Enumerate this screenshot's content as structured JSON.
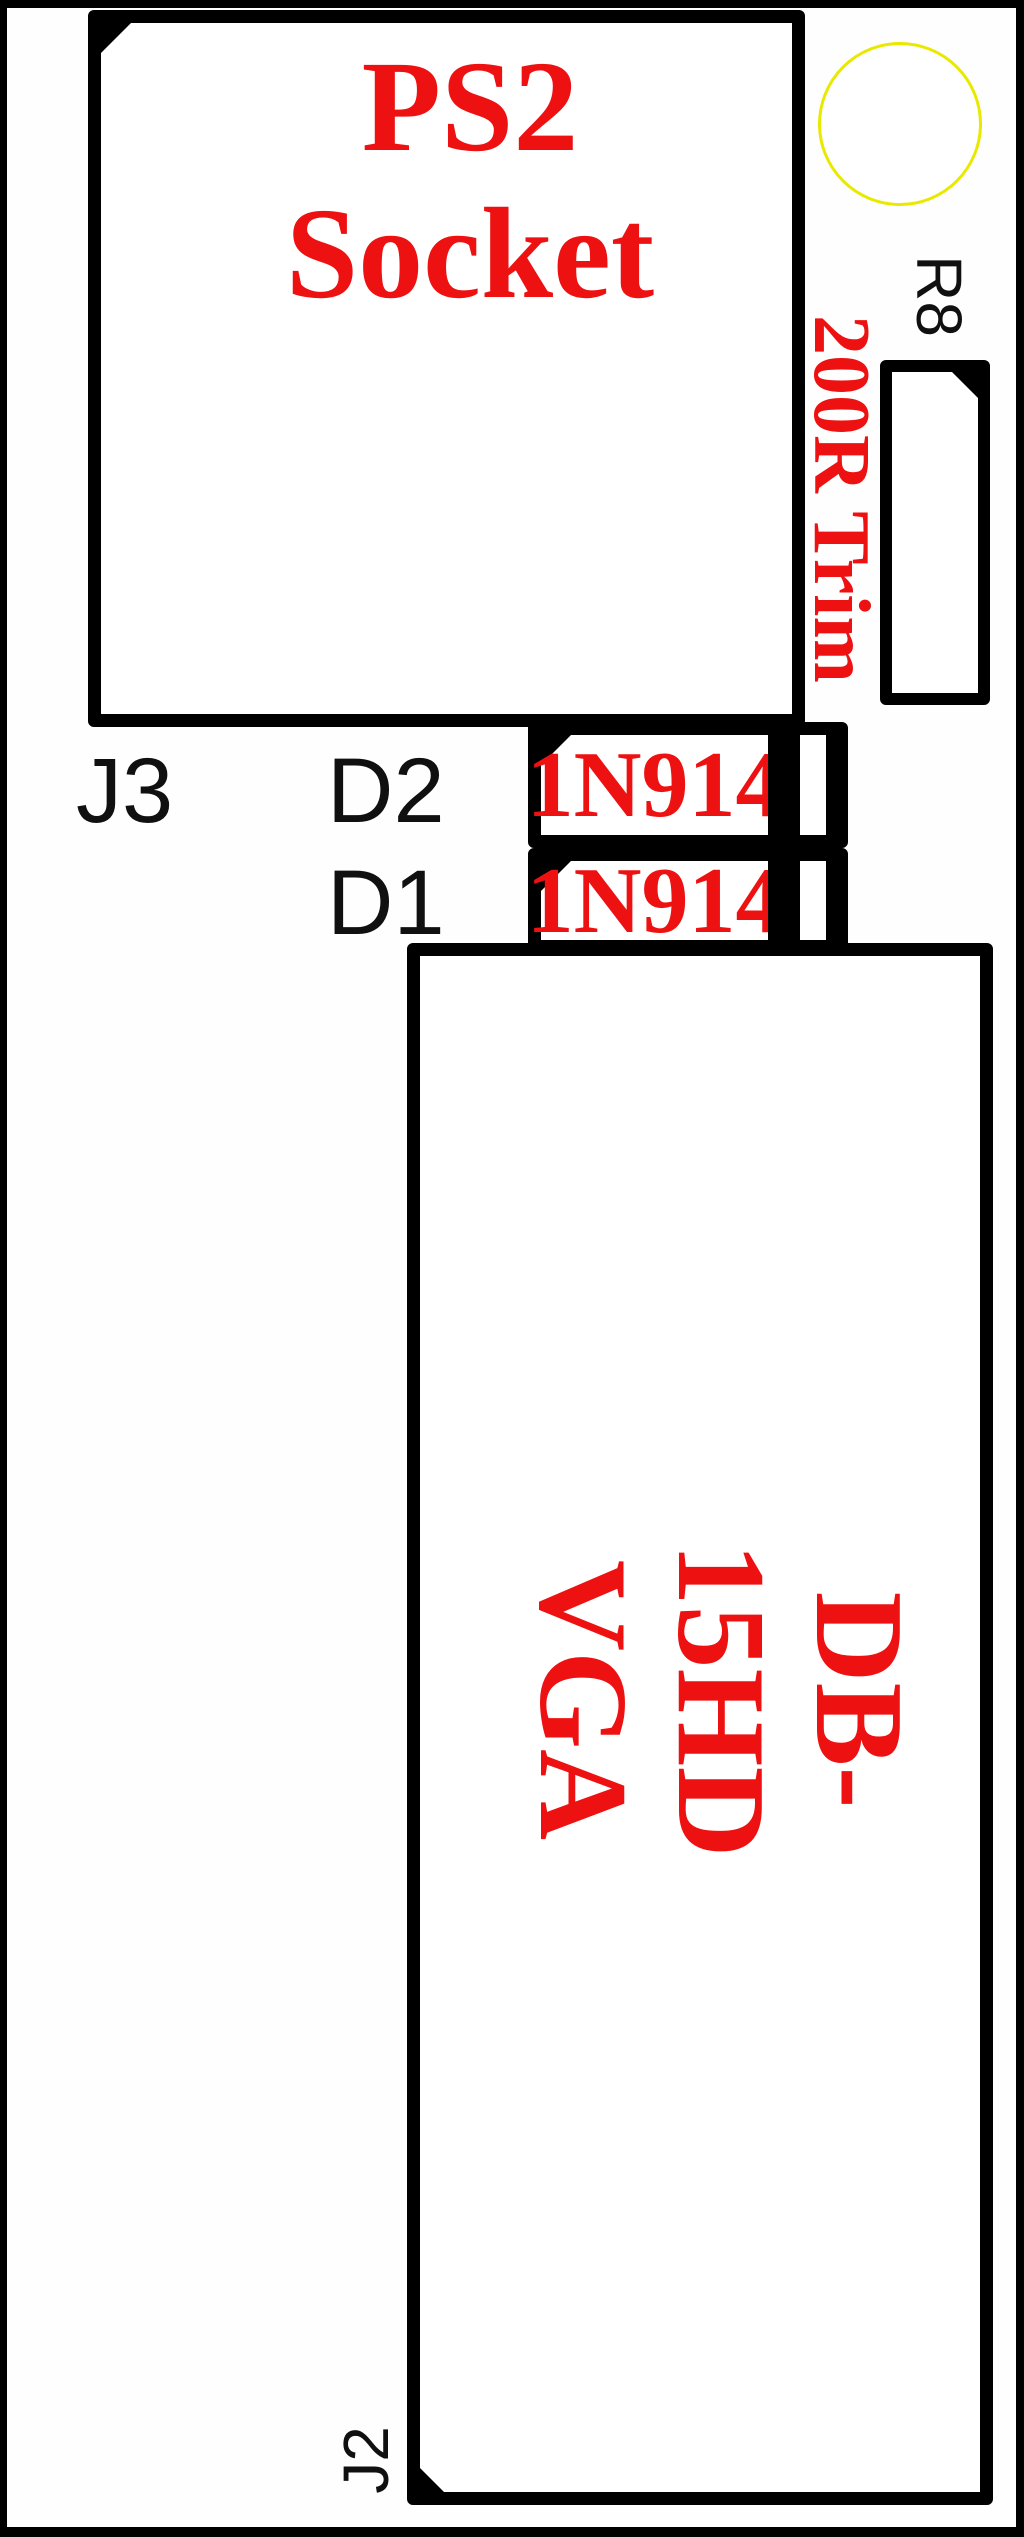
{
  "colors": {
    "accent_red": "#ee1111",
    "outline_black": "#000000",
    "hole_yellow": "#e9e900",
    "background": "#ffffff"
  },
  "ps2_socket": {
    "title_line1": "PS2",
    "title_line2": "Socket",
    "ref": "J3"
  },
  "trimmer": {
    "ref": "R8",
    "value": "200R Trim"
  },
  "diode_d2": {
    "ref": "D2",
    "part": "1N914"
  },
  "diode_d1": {
    "ref": "D1",
    "part": "1N914"
  },
  "vga_connector": {
    "type_line1": "DB-15HD",
    "type_line2": "VGA",
    "ref": "J2"
  }
}
